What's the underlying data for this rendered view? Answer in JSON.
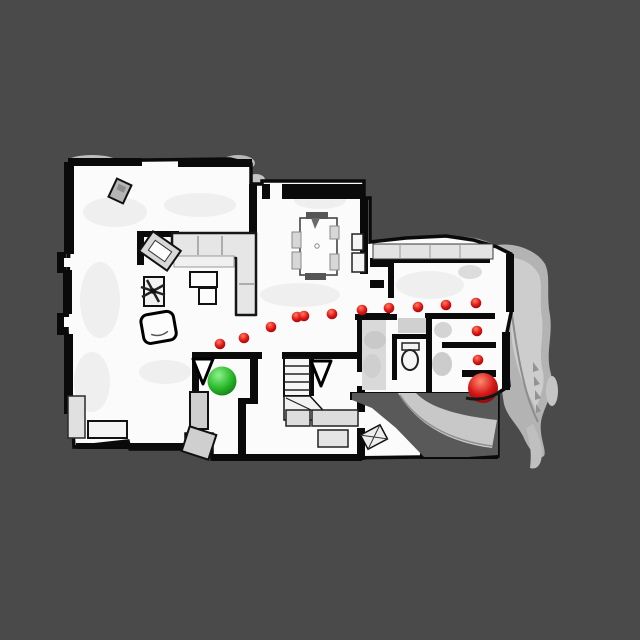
{
  "viewport": {
    "background_color": "#4a4a4a",
    "floor_color": "#fbfbfb",
    "wall_color": "#0a0a0a",
    "exterior_mesh_color": "#b3b3b3",
    "stairwell_color": "#595959"
  },
  "markers": {
    "start": {
      "icon": "start-sphere-icon",
      "x": 222,
      "y": 381,
      "r": 14.5,
      "color": "#2fbe2f",
      "gradient": [
        "#90f090",
        "#2fbe2f",
        "#0f7a0f"
      ]
    },
    "goal": {
      "icon": "goal-sphere-icon",
      "x": 483,
      "y": 388,
      "r": 15,
      "color": "#d51717",
      "gradient": [
        "#ff8a70",
        "#d51717",
        "#7e0606"
      ]
    },
    "waypoint_style": {
      "icon": "waypoint-dot-icon",
      "r": 5.3,
      "color": "#e01414",
      "gradient": [
        "#ff7d60",
        "#e01414",
        "#8e0707"
      ]
    },
    "waypoints": [
      {
        "x": 220,
        "y": 344
      },
      {
        "x": 244,
        "y": 338
      },
      {
        "x": 271,
        "y": 327
      },
      {
        "x": 297,
        "y": 317
      },
      {
        "x": 304,
        "y": 316
      },
      {
        "x": 332,
        "y": 314
      },
      {
        "x": 362,
        "y": 310
      },
      {
        "x": 389,
        "y": 308
      },
      {
        "x": 418,
        "y": 307
      },
      {
        "x": 446,
        "y": 305
      },
      {
        "x": 476,
        "y": 303
      },
      {
        "x": 477,
        "y": 331
      },
      {
        "x": 478,
        "y": 360
      }
    ]
  }
}
